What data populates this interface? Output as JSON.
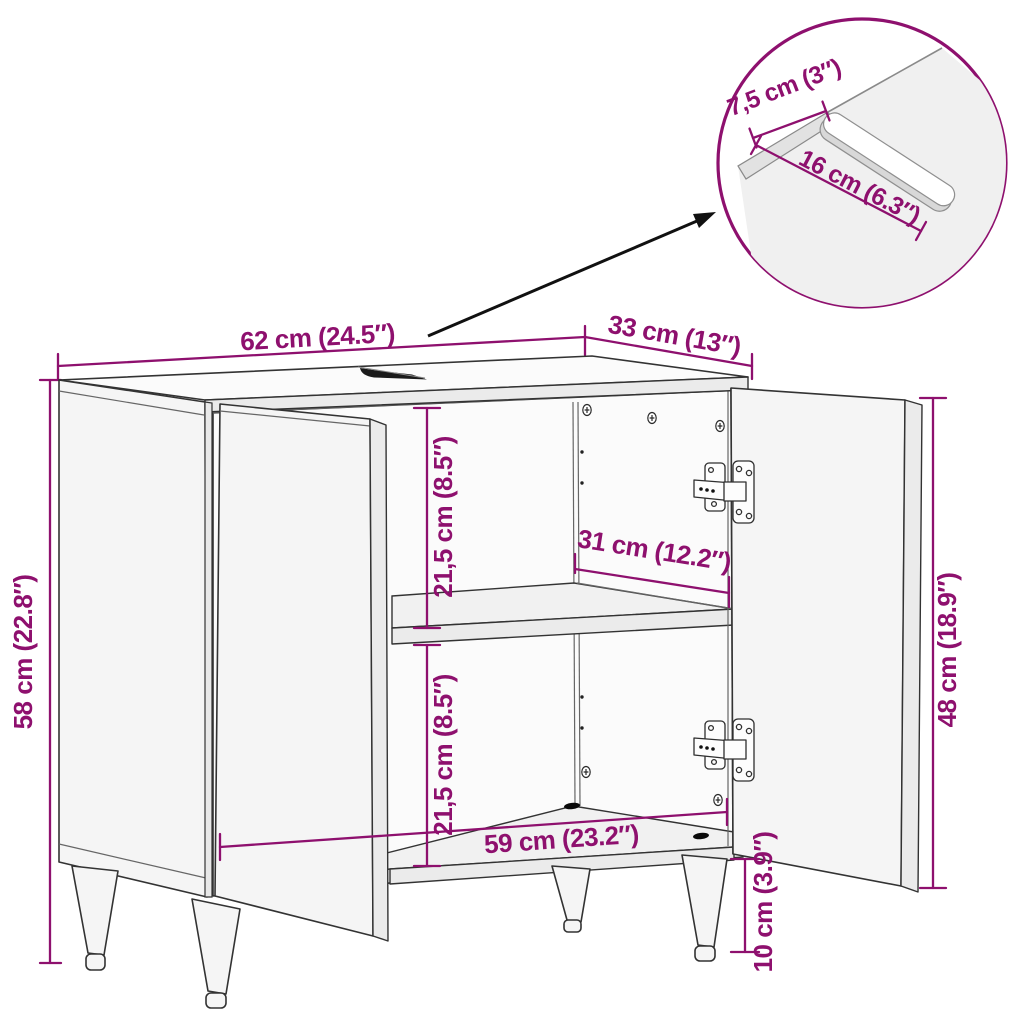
{
  "diagram": {
    "type": "furniture dimension diagram",
    "subject": "bathroom sink cabinet line drawing with open doors",
    "colors": {
      "dimension_accent": "#8e106e",
      "outline": "#333333",
      "arrow": "#111111",
      "background": "#ffffff"
    },
    "dimensions": {
      "top_width": {
        "label": "62 cm (24.5″)"
      },
      "top_depth": {
        "label": "33 cm (13″)"
      },
      "total_height": {
        "label": "58 cm (22.8″)"
      },
      "upper_compartment_height": {
        "label": "21,5 cm (8.5″)"
      },
      "shelf_depth": {
        "label": "31 cm (12.2″)"
      },
      "lower_compartment_height": {
        "label": "21,5 cm (8.5″)"
      },
      "inner_width": {
        "label": "59 cm (23.2″)"
      },
      "leg_height": {
        "label": "10 cm (3.9″)"
      },
      "door_height": {
        "label": "48 cm (18.9″)"
      }
    },
    "inset": {
      "cutout_edge_distance": {
        "label": "7,5 cm (3″)"
      },
      "cutout_length": {
        "label": "16 cm (6.3″)"
      }
    }
  }
}
